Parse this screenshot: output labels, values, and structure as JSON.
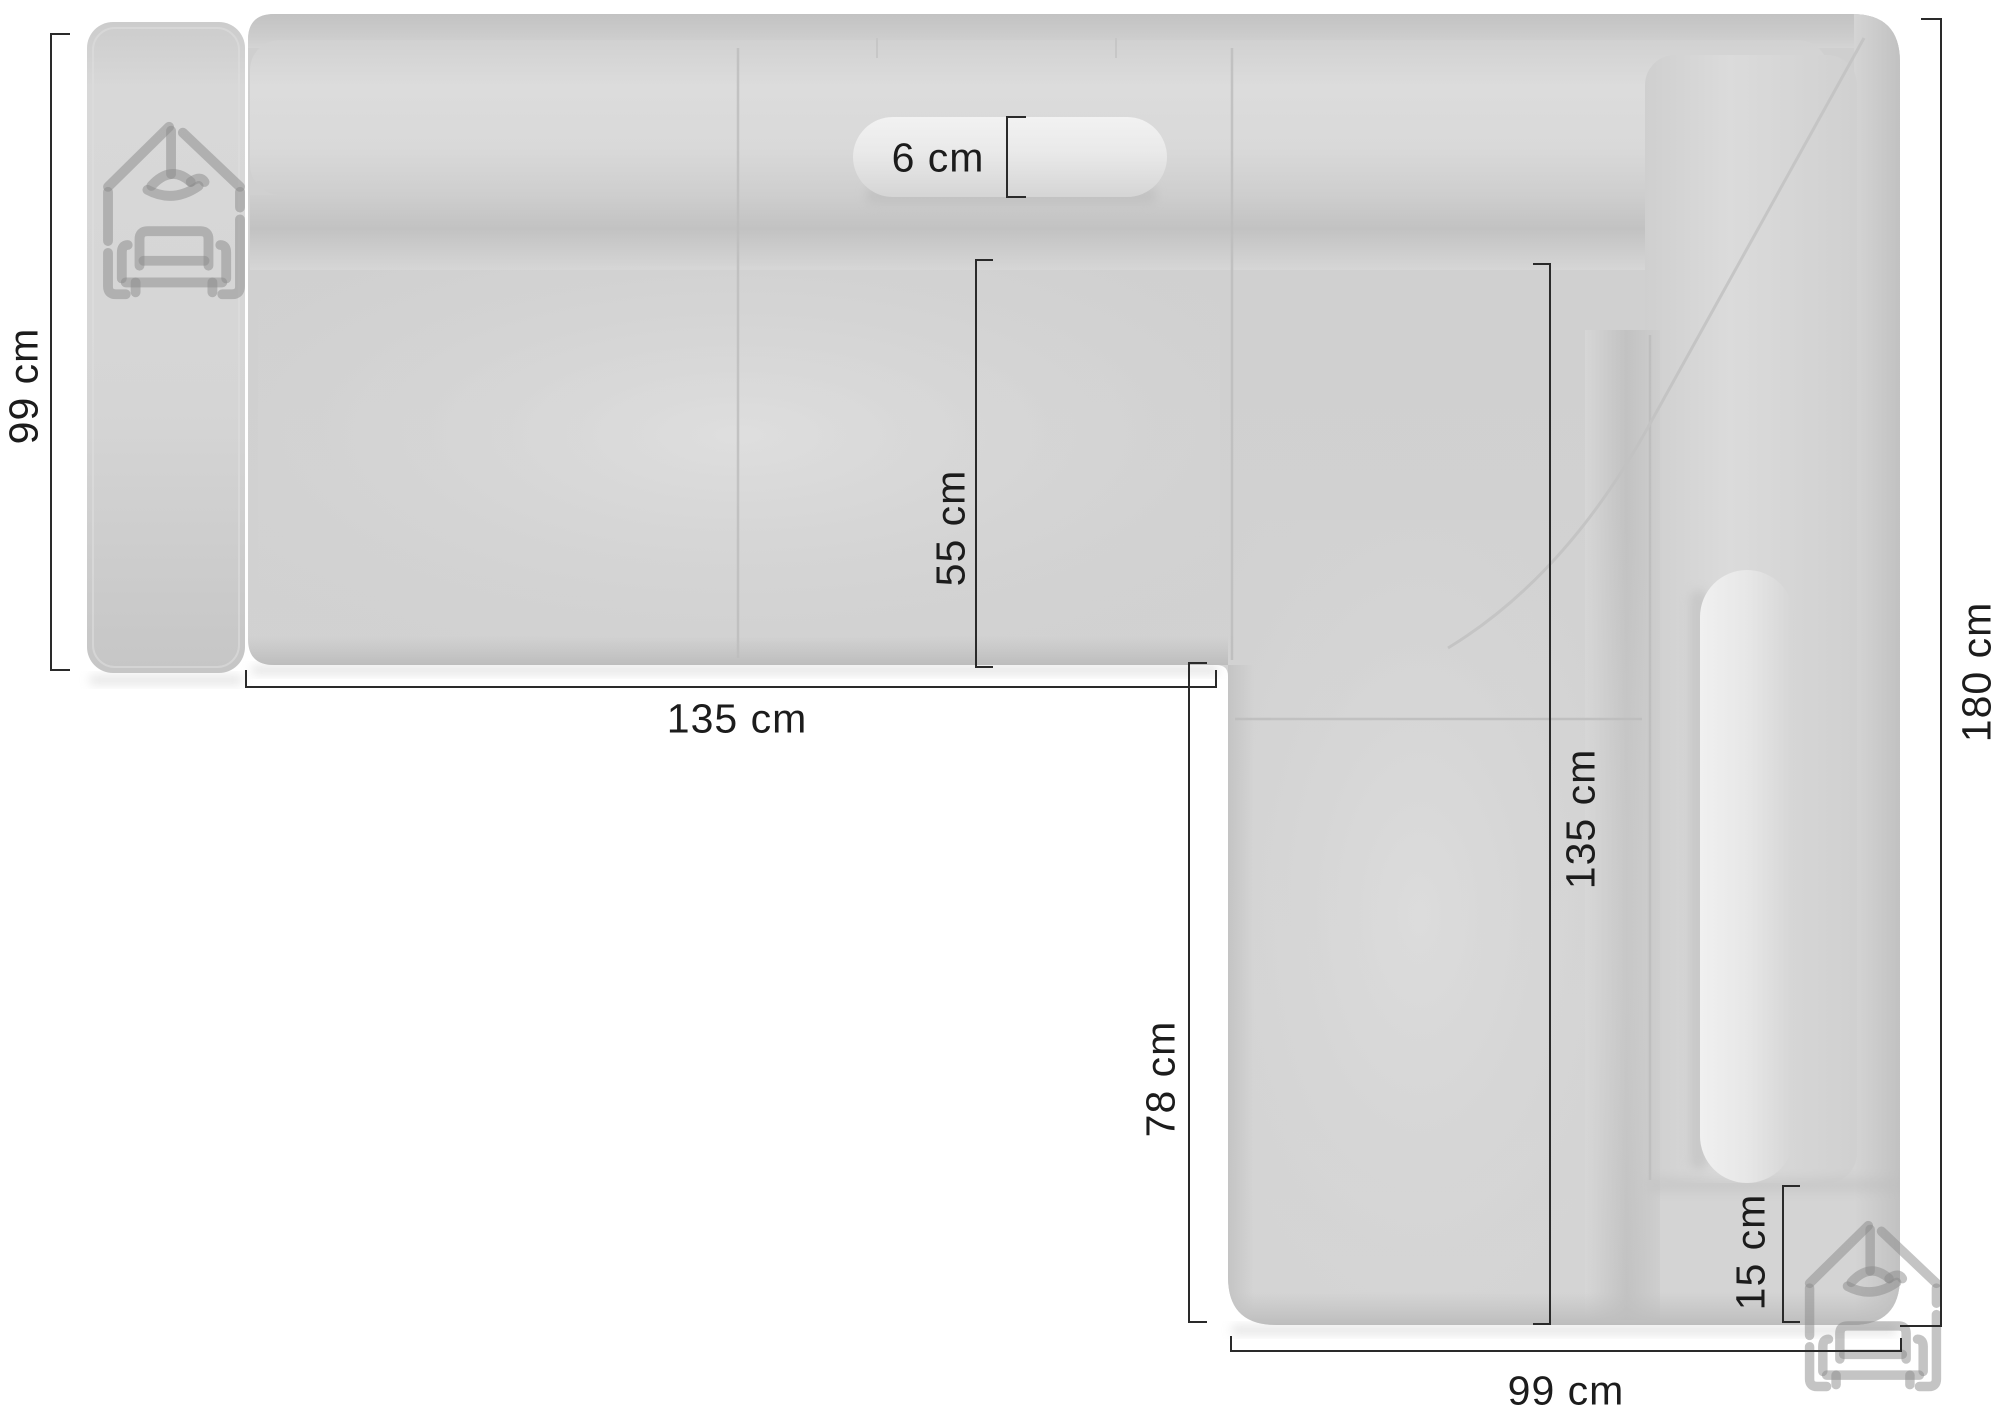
{
  "page": {
    "background_color": "#ffffff"
  },
  "diagram": {
    "title": "corner-sofa-top-view-dimension-diagram",
    "unit": "cm",
    "colors": {
      "sofa_body": "#d2d2d2",
      "sofa_cushion_highlight": "#dcdcdc",
      "pillow": "#ececec",
      "seam": "#bdbdbd",
      "dimension_line": "#2a2a2a",
      "dimension_text": "#1c1c1c",
      "watermark": "#8a8a8a"
    },
    "dimensions": [
      {
        "id": "sofa-depth-left",
        "label": "99 cm",
        "value": 99,
        "unit": "cm",
        "orientation": "vertical"
      },
      {
        "id": "seat-width-bottom",
        "label": "135 cm",
        "value": 135,
        "unit": "cm",
        "orientation": "horizontal"
      },
      {
        "id": "headrest-thickness",
        "label": "6 cm",
        "value": 6,
        "unit": "cm",
        "orientation": "vertical-bracket"
      },
      {
        "id": "seat-depth-middle",
        "label": "55 cm",
        "value": 55,
        "unit": "cm",
        "orientation": "vertical"
      },
      {
        "id": "chaise-side-length",
        "label": "78 cm",
        "value": 78,
        "unit": "cm",
        "orientation": "vertical"
      },
      {
        "id": "chaise-inner-length",
        "label": "135 cm",
        "value": 135,
        "unit": "cm",
        "orientation": "vertical"
      },
      {
        "id": "total-length-right",
        "label": "180 cm",
        "value": 180,
        "unit": "cm",
        "orientation": "vertical"
      },
      {
        "id": "base-ledge-height",
        "label": "15 cm",
        "value": 15,
        "unit": "cm",
        "orientation": "vertical-bracket"
      },
      {
        "id": "chaise-width-bottom",
        "label": "99 cm",
        "value": 99,
        "unit": "cm",
        "orientation": "horizontal"
      }
    ],
    "watermark_icon": "house-sofa-logo-icon"
  }
}
